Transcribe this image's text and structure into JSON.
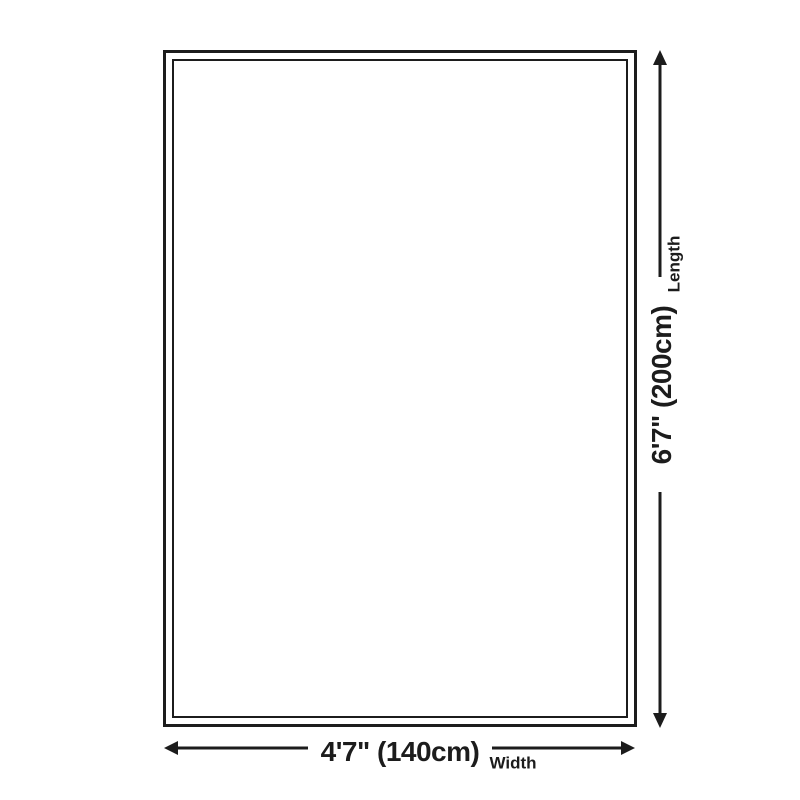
{
  "canvas": {
    "background": "#ffffff",
    "line_color": "#1c1c1c",
    "text_color": "#1c1c1c"
  },
  "diagram": {
    "type": "product-dimension-diagram",
    "shape": "rectangle-double-border",
    "length": {
      "value": "6'7\" (200cm)",
      "label": "Length",
      "arrow_icon": "vertical-double-headed-arrow"
    },
    "width": {
      "value": "4'7\" (140cm)",
      "label": "Width",
      "arrow_icon": "horizontal-double-headed-arrow"
    }
  }
}
